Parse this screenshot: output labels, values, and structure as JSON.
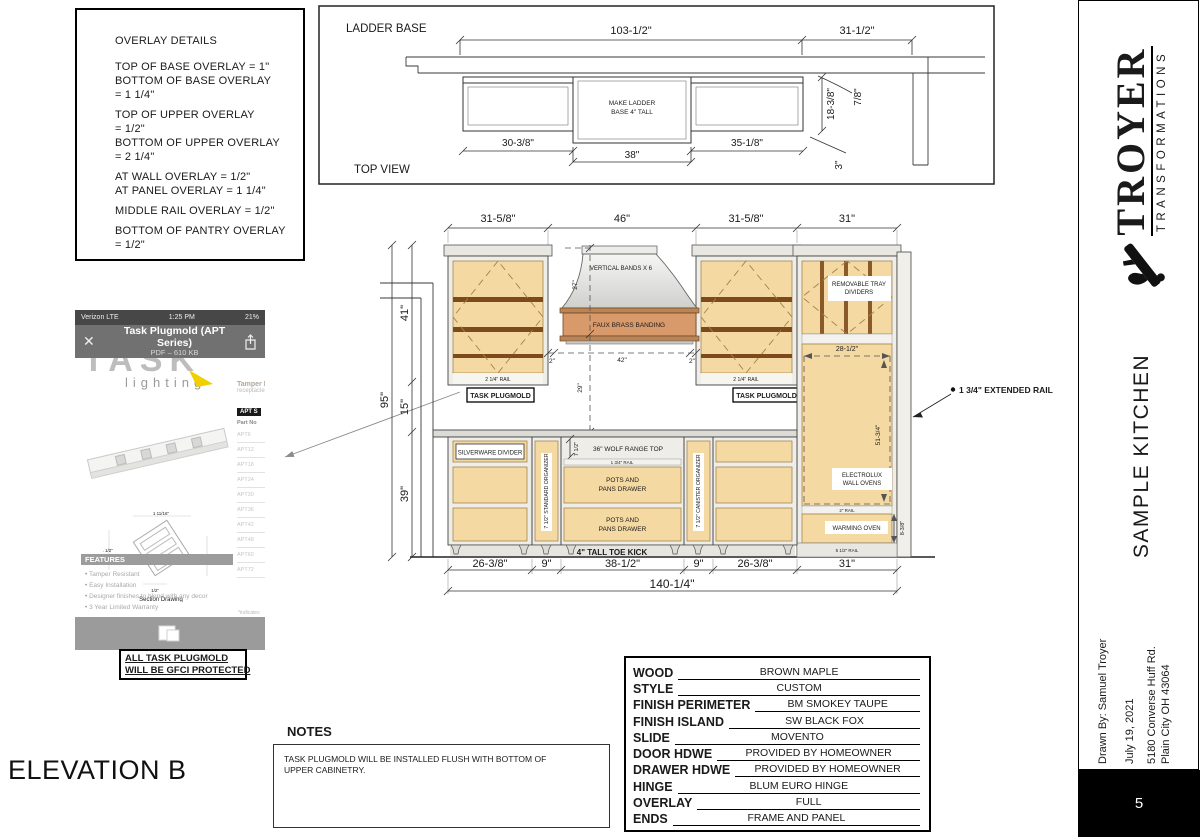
{
  "colors": {
    "wood": "#f5d9a2",
    "brass": "#d99a6b",
    "accent_yellow": "#f2cf00",
    "frame": "#efede8"
  },
  "sheet": {
    "elevation_title": "ELEVATION B",
    "page_number": "5"
  },
  "overlay_box": {
    "title": "OVERLAY DETAILS",
    "lines": [
      "TOP OF BASE OVERLAY = 1\"",
      "BOTTOM OF BASE OVERLAY",
      "= 1 1/4\"",
      "",
      "TOP OF UPPER OVERLAY",
      "= 1/2\"",
      "BOTTOM OF UPPER OVERLAY",
      "= 2 1/4\"",
      "",
      "AT WALL OVERLAY = 1/2\"",
      "AT PANEL OVERLAY = 1 1/4\"",
      "",
      "MIDDLE RAIL OVERLAY = 1/2\"",
      "",
      "BOTTOM OF PANTRY OVERLAY",
      "= 1/2\""
    ]
  },
  "top_view": {
    "title": "LADDER BASE",
    "view_label": "TOP VIEW",
    "note_line1": "MAKE LADDER",
    "note_line2": "BASE 4\" TALL",
    "dims": {
      "total": "103-1/2\"",
      "right": "31-1/2\"",
      "left_section": "30-3/8\"",
      "middle": "38\"",
      "right_section": "35-1/8\"",
      "depth": "18-3/8\"",
      "gap": "7/8\"",
      "protrusion": "3\""
    }
  },
  "elevation": {
    "top_dims": [
      "31-5/8\"",
      "46\"",
      "31-5/8\"",
      "31\""
    ],
    "left_dims": {
      "total": "95\"",
      "upper": "41\"",
      "mid": "15\"",
      "base": "39\""
    },
    "bottom_dims": [
      "26-3/8\"",
      "9\"",
      "38-1/2\"",
      "9\"",
      "26-3/8\"",
      "31\""
    ],
    "total_width": "140-1/4\"",
    "hood": {
      "bands": "VERTICAL BANDS X 6",
      "banding": "FAUX BRASS BANDING",
      "height": "27\"",
      "left_gap": "2\"",
      "opening": "42\"",
      "right_gap": "2\"",
      "below": "29\""
    },
    "labels": {
      "task_plugmold": "TASK PLUGMOLD",
      "rail_2_1_4": "2 1/4\" RAIL",
      "tray_line1": "REMOVABLE TRAY",
      "tray_line2": "DIVIDERS",
      "tray_width": "28-1/2\"",
      "oven_height": "51-3/4\"",
      "electrolux_line1": "ELECTROLUX",
      "electrolux_line2": "WALL OVENS",
      "rail_2": "2\" RAIL",
      "warming": "WARMING OVEN",
      "warming_height": "8-3/8\"",
      "rail_5_1_2": "5 1/2\" RAIL",
      "extended_rail": "1 3/4\" EXTENDED RAIL",
      "silverware": "SILVERWARE DIVIDER",
      "standard_organizer": "7 1/2\" STANDARD ORGANIZER",
      "canister_organizer": "7 1/2\" CANISTER ORGANIZER",
      "range_top": "36\" WOLF RANGE TOP",
      "range_gap_height": "7 1/2\"",
      "rail_1_3_4": "1 3/4\" RAIL",
      "pots_line1": "POTS AND",
      "pots_line2": "PANS DRAWER",
      "toe_kick": "4\" TALL TOE KICK"
    }
  },
  "phone": {
    "status": {
      "carrier": "Verizon LTE",
      "time": "1:25 PM",
      "battery": "21%"
    },
    "header": {
      "close": "✕",
      "title": "Task Plugmold (APT Series)",
      "subtitle": "PDF – 610 KB"
    },
    "logo": {
      "brand": "TASK",
      "sub": "lighting"
    },
    "right": {
      "heading": "Tamper Resista",
      "sub": "receptacles and",
      "table_header": "APT S",
      "table_sub": "Part No",
      "parts": [
        "APT6",
        "APT12",
        "APT18",
        "APT24",
        "APT30",
        "APT36",
        "APT42",
        "APT48",
        "APT60",
        "APT72"
      ],
      "footnote": "*indicates"
    },
    "section": {
      "caption": "Section Drawing",
      "dim_top": "1 11/16\"",
      "dim_left": "1 1/2\"",
      "dim_right": "1 5/8\"",
      "dim_bottom": "1/2\""
    },
    "features": {
      "title": "FEATURES",
      "items": [
        "Tamper Resistant",
        "Easy Installation",
        "Designer finishes to blend with any decor",
        "3 Year Limited Warranty"
      ]
    },
    "msg_icon": "✉"
  },
  "gfci_note": {
    "line1": "ALL TASK PLUGMOLD",
    "line2": "WILL BE GFCI PROTECTED"
  },
  "notes": {
    "title": "NOTES",
    "body": "TASK PLUGMOLD WILL BE INSTALLED FLUSH WITH BOTTOM OF UPPER CABINETRY."
  },
  "spec_table": {
    "rows": [
      {
        "label": "WOOD",
        "value": "BROWN MAPLE"
      },
      {
        "label": "STYLE",
        "value": "CUSTOM"
      },
      {
        "label": "FINISH PERIMETER",
        "value": "BM SMOKEY TAUPE"
      },
      {
        "label": "FINISH ISLAND",
        "value": "SW BLACK FOX"
      },
      {
        "label": "SLIDE",
        "value": "MOVENTO"
      },
      {
        "label": "DOOR HDWE",
        "value": "PROVIDED BY HOMEOWNER"
      },
      {
        "label": "DRAWER HDWE",
        "value": "PROVIDED BY HOMEOWNER"
      },
      {
        "label": "HINGE",
        "value": "BLUM EURO HINGE"
      },
      {
        "label": "OVERLAY",
        "value": "FULL"
      },
      {
        "label": "ENDS",
        "value": "FRAME AND PANEL"
      }
    ]
  },
  "sidebar": {
    "brand": "TROYER",
    "brand_sub": "TRANSFORMATIONS",
    "project": "SAMPLE KITCHEN",
    "drawn_by": "Drawn By: Samuel Troyer",
    "date": "July 19, 2021",
    "address1": "5180 Converse Huff Rd.",
    "address2": "Plain City OH 43064"
  }
}
